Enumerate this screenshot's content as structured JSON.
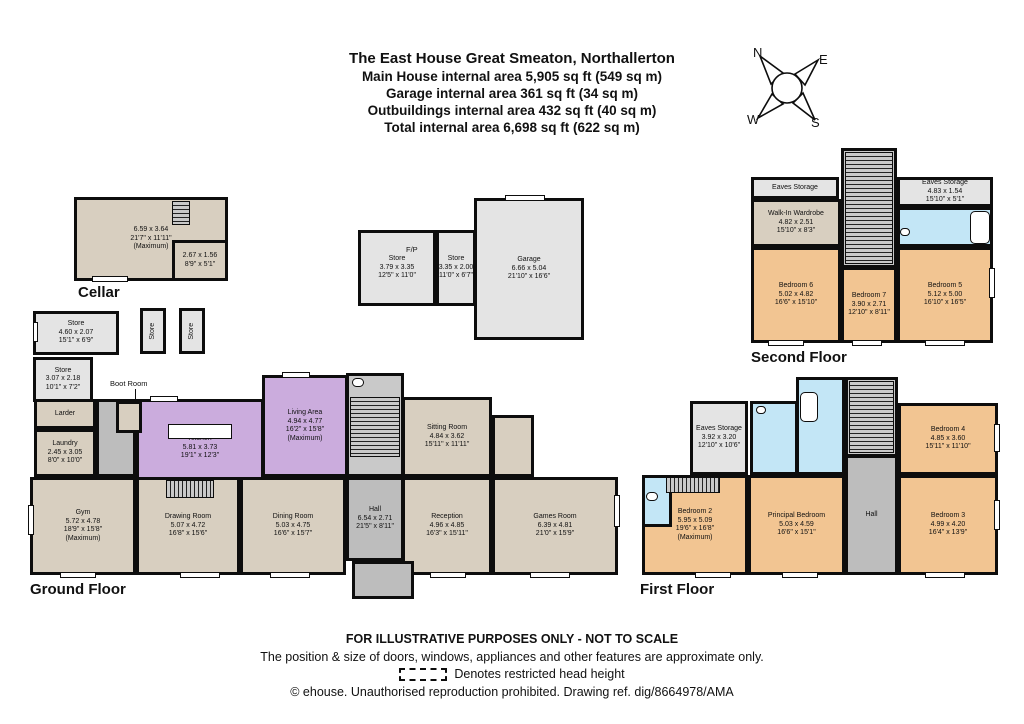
{
  "title": {
    "line1": "The East House Great Smeaton, Northallerton",
    "line2": "Main House internal area 5,905 sq ft (549 sq m)",
    "line3": "Garage internal area 361 sq ft (34 sq m)",
    "line4": "Outbuildings internal area 432 sq ft (40 sq m)",
    "line5": "Total internal area 6,698 sq ft (622 sq m)"
  },
  "compass": {
    "north": "N",
    "east": "E",
    "south": "S",
    "west": "W"
  },
  "palette": {
    "wall": "#0d0d0d",
    "floor_tan": "#d8cfc0",
    "floor_purple": "#cbacdd",
    "floor_peach": "#f2c592",
    "floor_blue": "#c3e6f6",
    "floor_gray": "#e4e4e4",
    "floor_hall": "#bdbdbd",
    "floor_stairs": "#c9c9c9"
  },
  "rooms": [
    {
      "id": "cellar-main",
      "x": 74,
      "y": 197,
      "w": 154,
      "h": 84,
      "color": "tan",
      "lines": [
        "6.59 x 3.64",
        "21'7\" x 11'11\"",
        "(Maximum)"
      ]
    },
    {
      "id": "cellar-store",
      "x": 172,
      "y": 240,
      "w": 56,
      "h": 41,
      "color": "tan",
      "lines": [
        "2.67 x 1.56",
        "8'9\" x 5'1\""
      ]
    },
    {
      "id": "store-1",
      "x": 33,
      "y": 311,
      "w": 86,
      "h": 44,
      "color": "gray",
      "lines": [
        "Store",
        "4.60 x 2.07",
        "15'1\" x 6'9\""
      ]
    },
    {
      "id": "store-v1",
      "x": 140,
      "y": 308,
      "w": 26,
      "h": 46,
      "color": "gray",
      "vertical": true,
      "lines": [
        "Store"
      ]
    },
    {
      "id": "store-v2",
      "x": 179,
      "y": 308,
      "w": 26,
      "h": 46,
      "color": "gray",
      "vertical": true,
      "lines": [
        "Store"
      ]
    },
    {
      "id": "store-2",
      "x": 33,
      "y": 357,
      "w": 60,
      "h": 45,
      "color": "gray",
      "lines": [
        "Store",
        "3.07 x 2.18",
        "10'1\" x 7'2\""
      ]
    },
    {
      "id": "outbuilding-store-fp",
      "x": 358,
      "y": 230,
      "w": 78,
      "h": 76,
      "color": "gray",
      "lines": [
        "Store",
        "3.79 x 3.35",
        "12'5\" x 11'0\""
      ]
    },
    {
      "id": "outbuilding-store-small",
      "x": 436,
      "y": 230,
      "w": 40,
      "h": 76,
      "color": "gray",
      "lines": [
        "Store",
        "3.35 x 2.00",
        "11'0\" x 6'7\""
      ]
    },
    {
      "id": "garage",
      "x": 474,
      "y": 198,
      "w": 110,
      "h": 142,
      "color": "gray",
      "lines": [
        "Garage",
        "6.66 x 5.04",
        "21'10\" x 16'6\""
      ]
    },
    {
      "id": "larder",
      "x": 34,
      "y": 399,
      "w": 62,
      "h": 30,
      "color": "tan",
      "lines": [
        "Larder"
      ]
    },
    {
      "id": "laundry",
      "x": 34,
      "y": 429,
      "w": 62,
      "h": 48,
      "color": "tan",
      "lines": [
        "Laundry",
        "2.45 x 3.05",
        "8'0\" x 10'0\""
      ]
    },
    {
      "id": "kitchen",
      "x": 136,
      "y": 399,
      "w": 128,
      "h": 98,
      "color": "purple",
      "lines": [
        "Kitchen",
        "5.81 x 3.73",
        "19'1\" x 12'3\""
      ]
    },
    {
      "id": "living-area",
      "x": 262,
      "y": 375,
      "w": 86,
      "h": 102,
      "color": "purple",
      "lines": [
        "Living Area",
        "4.94 x 4.77",
        "16'2\" x 15'8\"",
        "(Maximum)"
      ]
    },
    {
      "id": "gf-hall",
      "x": 346,
      "y": 477,
      "w": 58,
      "h": 84,
      "color": "hall",
      "lines": [
        "Hall",
        "6.54 x 2.71",
        "21'5\" x 8'11\""
      ]
    },
    {
      "id": "sitting-room",
      "x": 402,
      "y": 397,
      "w": 90,
      "h": 80,
      "color": "tan",
      "lines": [
        "Sitting Room",
        "4.84 x 3.62",
        "15'11\" x 11'11\""
      ]
    },
    {
      "id": "gym",
      "x": 30,
      "y": 477,
      "w": 106,
      "h": 98,
      "color": "tan",
      "lines": [
        "Gym",
        "5.72 x 4.78",
        "18'9\" x 15'8\"",
        "(Maximum)"
      ]
    },
    {
      "id": "drawing-room",
      "x": 136,
      "y": 477,
      "w": 104,
      "h": 98,
      "color": "tan",
      "lines": [
        "Drawing Room",
        "5.07 x 4.72",
        "16'8\" x 15'6\""
      ]
    },
    {
      "id": "dining-room",
      "x": 240,
      "y": 477,
      "w": 106,
      "h": 98,
      "color": "tan",
      "lines": [
        "Dining Room",
        "5.03 x 4.75",
        "16'6\" x 15'7\""
      ]
    },
    {
      "id": "reception",
      "x": 402,
      "y": 477,
      "w": 90,
      "h": 98,
      "color": "tan",
      "lines": [
        "Reception",
        "4.96 x 4.85",
        "16'3\" x 15'11\""
      ]
    },
    {
      "id": "games-room",
      "x": 492,
      "y": 477,
      "w": 126,
      "h": 98,
      "color": "tan",
      "lines": [
        "Games Room",
        "6.39 x 4.81",
        "21'0\" x 15'9\""
      ]
    },
    {
      "id": "eaves-storage-left",
      "x": 751,
      "y": 177,
      "w": 88,
      "h": 22,
      "color": "gray",
      "lines": [
        "Eaves Storage"
      ]
    },
    {
      "id": "eaves-storage-right",
      "x": 897,
      "y": 177,
      "w": 96,
      "h": 30,
      "color": "gray",
      "lines": [
        "Eaves Storage",
        "4.83 x 1.54",
        "15'10\" x 5'1\""
      ]
    },
    {
      "id": "walk-in-wardrobe",
      "x": 751,
      "y": 199,
      "w": 90,
      "h": 48,
      "color": "tan",
      "lines": [
        "Walk-In Wardrobe",
        "4.82 x 2.51",
        "15'10\" x 8'3\""
      ]
    },
    {
      "id": "bedroom-6",
      "x": 751,
      "y": 247,
      "w": 90,
      "h": 96,
      "color": "peach",
      "lines": [
        "Bedroom 6",
        "5.02 x 4.82",
        "16'6\" x 15'10\""
      ]
    },
    {
      "id": "bedroom-7",
      "x": 841,
      "y": 267,
      "w": 56,
      "h": 76,
      "color": "peach",
      "lines": [
        "Bedroom 7",
        "3.90 x 2.71",
        "12'10\" x 8'11\""
      ]
    },
    {
      "id": "bedroom-5",
      "x": 897,
      "y": 247,
      "w": 96,
      "h": 96,
      "color": "peach",
      "lines": [
        "Bedroom 5",
        "5.12 x 5.00",
        "16'10\" x 16'5\""
      ]
    },
    {
      "id": "ff-eaves-storage",
      "x": 690,
      "y": 401,
      "w": 58,
      "h": 74,
      "color": "gray",
      "lines": [
        "Eaves Storage",
        "3.92 x 3.20",
        "12'10\" x 10'6\""
      ]
    },
    {
      "id": "bedroom-4",
      "x": 898,
      "y": 403,
      "w": 100,
      "h": 72,
      "color": "peach",
      "lines": [
        "Bedroom 4",
        "4.85 x 3.60",
        "15'11\" x 11'10\""
      ]
    },
    {
      "id": "bedroom-2",
      "x": 642,
      "y": 475,
      "w": 106,
      "h": 100,
      "color": "peach",
      "lines": [
        "Bedroom 2",
        "5.95 x 5.09",
        "19'6\" x 16'8\"",
        "(Maximum)"
      ]
    },
    {
      "id": "principal-bedroom",
      "x": 748,
      "y": 475,
      "w": 97,
      "h": 100,
      "color": "peach",
      "lines": [
        "Principal Bedroom",
        "5.03 x 4.59",
        "16'6\" x 15'1\""
      ]
    },
    {
      "id": "ff-hall",
      "x": 845,
      "y": 455,
      "w": 53,
      "h": 120,
      "color": "hall",
      "lines": [
        "Hall"
      ]
    },
    {
      "id": "bedroom-3",
      "x": 898,
      "y": 475,
      "w": 100,
      "h": 100,
      "color": "peach",
      "lines": [
        "Bedroom 3",
        "4.99 x 4.20",
        "16'4\" x 13'9\""
      ]
    }
  ],
  "shapes": [
    {
      "id": "gf-corridor",
      "x": 96,
      "y": 399,
      "w": 40,
      "h": 78,
      "color": "hall"
    },
    {
      "id": "boot-room",
      "x": 116,
      "y": 401,
      "w": 26,
      "h": 32,
      "color": "tan"
    },
    {
      "id": "gf-stair-block",
      "x": 346,
      "y": 373,
      "w": 58,
      "h": 104,
      "color": "stairs"
    },
    {
      "id": "gf-porch",
      "x": 352,
      "y": 561,
      "w": 62,
      "h": 38,
      "color": "hall"
    },
    {
      "id": "gf-rear-corridor",
      "x": 492,
      "y": 415,
      "w": 42,
      "h": 62,
      "color": "tan"
    },
    {
      "id": "sf-stairwell",
      "x": 841,
      "y": 148,
      "w": 56,
      "h": 120,
      "color": "stairs"
    },
    {
      "id": "sf-bathroom",
      "x": 897,
      "y": 207,
      "w": 96,
      "h": 40,
      "color": "blue"
    },
    {
      "id": "ff-shower-room",
      "x": 750,
      "y": 401,
      "w": 48,
      "h": 74,
      "color": "blue"
    },
    {
      "id": "ff-bathroom",
      "x": 796,
      "y": 377,
      "w": 49,
      "h": 98,
      "color": "blue"
    },
    {
      "id": "ff-stairwell",
      "x": 845,
      "y": 377,
      "w": 53,
      "h": 80,
      "color": "stairs"
    },
    {
      "id": "ff-wc",
      "x": 642,
      "y": 475,
      "w": 30,
      "h": 52,
      "color": "blue"
    }
  ],
  "stairs": [
    {
      "id": "cellar-stairs",
      "x": 172,
      "y": 201,
      "w": 18,
      "h": 24,
      "dir": "v"
    },
    {
      "id": "gf-stairs",
      "x": 350,
      "y": 397,
      "w": 50,
      "h": 60,
      "dir": "v"
    },
    {
      "id": "drawing-room-stairs",
      "x": 166,
      "y": 480,
      "w": 48,
      "h": 18,
      "dir": "h"
    },
    {
      "id": "sf-stairs",
      "x": 845,
      "y": 152,
      "w": 48,
      "h": 112,
      "dir": "v"
    },
    {
      "id": "ff-stairs",
      "x": 849,
      "y": 381,
      "w": 45,
      "h": 72,
      "dir": "v"
    },
    {
      "id": "bedroom2-stairs",
      "x": 666,
      "y": 477,
      "w": 54,
      "h": 16,
      "dir": "h"
    }
  ],
  "windows": [
    {
      "x": 60,
      "y": 572,
      "w": 36,
      "h": 6
    },
    {
      "x": 180,
      "y": 572,
      "w": 40,
      "h": 6
    },
    {
      "x": 270,
      "y": 572,
      "w": 40,
      "h": 6
    },
    {
      "x": 430,
      "y": 572,
      "w": 36,
      "h": 6
    },
    {
      "x": 530,
      "y": 572,
      "w": 40,
      "h": 6
    },
    {
      "x": 614,
      "y": 495,
      "w": 6,
      "h": 32
    },
    {
      "x": 150,
      "y": 396,
      "w": 28,
      "h": 6
    },
    {
      "x": 282,
      "y": 372,
      "w": 28,
      "h": 6
    },
    {
      "x": 505,
      "y": 195,
      "w": 40,
      "h": 6
    },
    {
      "x": 28,
      "y": 505,
      "w": 6,
      "h": 30
    },
    {
      "x": 92,
      "y": 276,
      "w": 36,
      "h": 6
    },
    {
      "x": 768,
      "y": 340,
      "w": 36,
      "h": 6
    },
    {
      "x": 852,
      "y": 340,
      "w": 30,
      "h": 6
    },
    {
      "x": 925,
      "y": 340,
      "w": 40,
      "h": 6
    },
    {
      "x": 989,
      "y": 268,
      "w": 6,
      "h": 30
    },
    {
      "x": 695,
      "y": 572,
      "w": 36,
      "h": 6
    },
    {
      "x": 782,
      "y": 572,
      "w": 36,
      "h": 6
    },
    {
      "x": 925,
      "y": 572,
      "w": 40,
      "h": 6
    },
    {
      "x": 994,
      "y": 500,
      "w": 6,
      "h": 30
    },
    {
      "x": 994,
      "y": 424,
      "w": 6,
      "h": 28
    },
    {
      "x": 33,
      "y": 322,
      "w": 5,
      "h": 20
    }
  ],
  "fixtures": [
    {
      "id": "kitchen-island",
      "type": "rect",
      "x": 168,
      "y": 424,
      "w": 64,
      "h": 15
    },
    {
      "id": "bathtub-second-floor",
      "type": "round",
      "x": 970,
      "y": 211,
      "w": 20,
      "h": 33
    },
    {
      "id": "bathtub-first-floor",
      "type": "round",
      "x": 800,
      "y": 392,
      "w": 18,
      "h": 30
    },
    {
      "id": "toilet-gf",
      "type": "round",
      "x": 352,
      "y": 378,
      "w": 12,
      "h": 9
    },
    {
      "id": "toilet-ff-wc",
      "type": "round",
      "x": 646,
      "y": 492,
      "w": 12,
      "h": 9
    },
    {
      "id": "toilet-sf-bath",
      "type": "round",
      "x": 900,
      "y": 228,
      "w": 10,
      "h": 8
    },
    {
      "id": "toilet-ff-shower",
      "type": "round",
      "x": 756,
      "y": 406,
      "w": 10,
      "h": 8
    },
    {
      "id": "boot-room-arrow",
      "type": "line",
      "x": 135,
      "y": 389,
      "w": 1,
      "h": 13
    }
  ],
  "labels": [
    {
      "id": "cellar-label",
      "text": "Cellar",
      "x": 78,
      "y": 284,
      "cls": "floor-label"
    },
    {
      "id": "ground-floor-label",
      "text": "Ground Floor",
      "x": 30,
      "y": 581,
      "cls": "floor-label"
    },
    {
      "id": "second-floor-label",
      "text": "Second Floor",
      "x": 751,
      "y": 349,
      "cls": "floor-label"
    },
    {
      "id": "first-floor-label",
      "text": "First Floor",
      "x": 640,
      "y": 581,
      "cls": "floor-label"
    },
    {
      "id": "boot-room-label",
      "text": "Boot Room",
      "x": 110,
      "y": 379,
      "cls": "small-label"
    },
    {
      "id": "fireplace-label",
      "text": "F/P",
      "x": 406,
      "y": 245,
      "cls": "small-label"
    }
  ],
  "footer": {
    "line1": "FOR ILLUSTRATIVE PURPOSES ONLY - NOT TO SCALE",
    "line2": "The position & size of doors, windows, appliances and other features are approximate only.",
    "line3": "Denotes restricted head height",
    "line4": "© ehouse. Unauthorised reproduction prohibited. Drawing ref. dig/8664978/AMA"
  }
}
